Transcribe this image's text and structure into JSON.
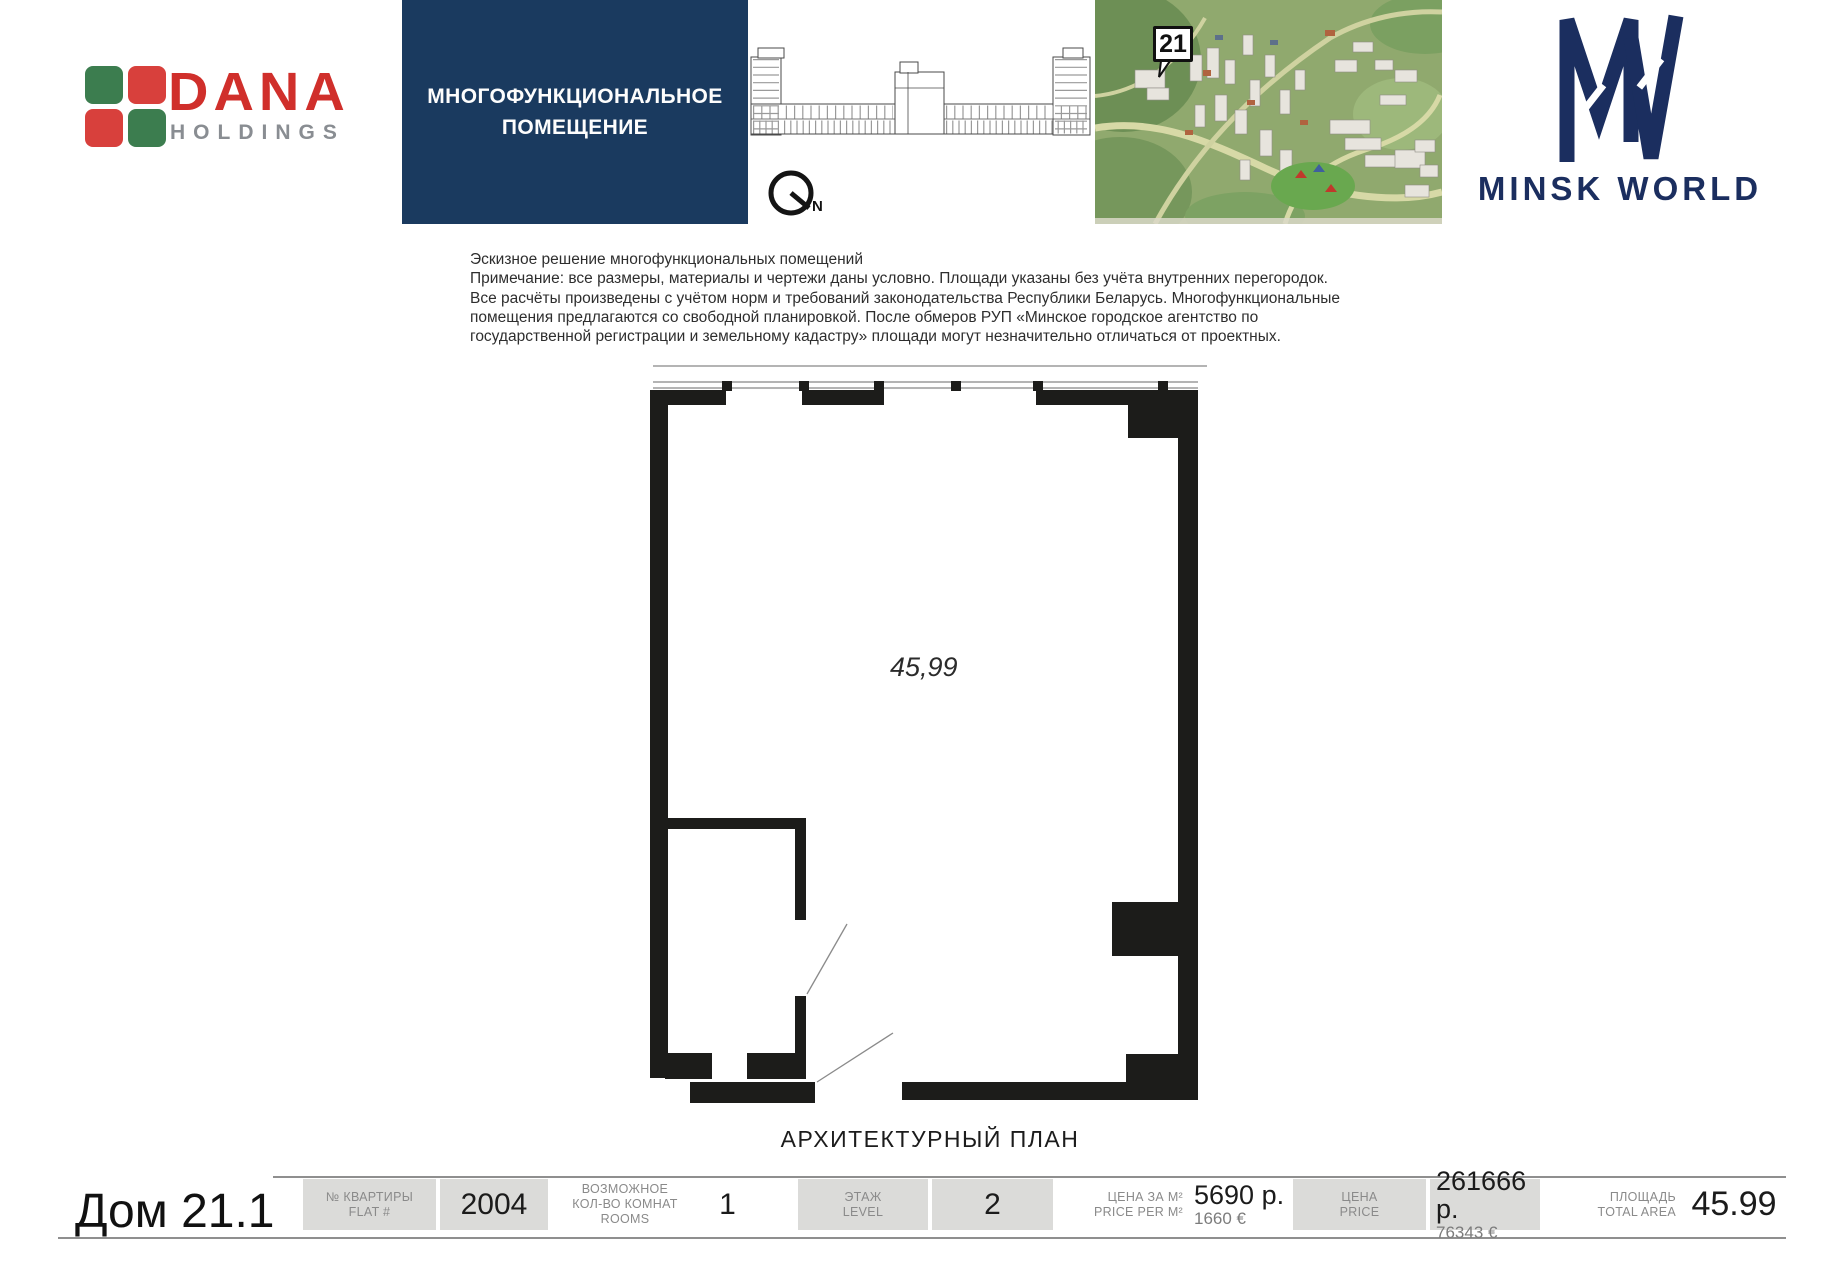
{
  "header": {
    "dana_logo": {
      "word": "DANA",
      "sub": "HOLDINGS",
      "red": "#d02f2b",
      "green": "#3c7d4f"
    },
    "type_banner": {
      "text": "МНОГОФУНКЦИОНАЛЬНОЕ ПОМЕЩЕНИЕ",
      "bg": "#1a3a5f"
    },
    "compass_label": "N",
    "map_marker": "21",
    "brand": {
      "name": "MINSK WORLD",
      "color": "#1b2e5f"
    }
  },
  "disclaimer": {
    "lines": [
      "Эскизное решение многофункциональных помещений",
      "Примечание: все размеры, материалы и чертежи даны условно. Площади указаны без учёта внутренних перегородок.",
      "Все расчёты произведены с учётом норм и требований законодательства Республики Беларусь. Многофункциональные",
      "помещения предлагаются со свободной планировкой. После обмеров РУП «Минское городское агентство по",
      "государственной регистрации и земельному кадастру» площади могут незначительно отличаться от проектных."
    ]
  },
  "plan": {
    "area_label": "45,99",
    "caption": "АРХИТЕКТУРНЫЙ ПЛАН"
  },
  "footer": {
    "building": "Дом 21.1",
    "cells": {
      "flat": {
        "label1": "№ КВАРТИРЫ",
        "label2": "FLAT #",
        "value": "2004"
      },
      "rooms": {
        "label1": "ВОЗМОЖНОЕ",
        "label2": "КОЛ-ВО КОМНАТ",
        "label3": "ROOMS",
        "value": "1"
      },
      "level": {
        "label1": "ЭТАЖ",
        "label2": "LEVEL",
        "value": "2"
      },
      "price_per_m2": {
        "label1": "ЦЕНА ЗА М²",
        "label2": "PRICE PER M²",
        "value": "5690 р.",
        "value_eur": "1660 €"
      },
      "price": {
        "label1": "ЦЕНА",
        "label2": "PRICE",
        "value": "261666 р.",
        "value_eur": "76343 €"
      },
      "area": {
        "label1": "ПЛОЩАДЬ",
        "label2": "TOTAL AREA",
        "value": "45.99"
      }
    },
    "cell_gray": "#dbdbd9"
  }
}
